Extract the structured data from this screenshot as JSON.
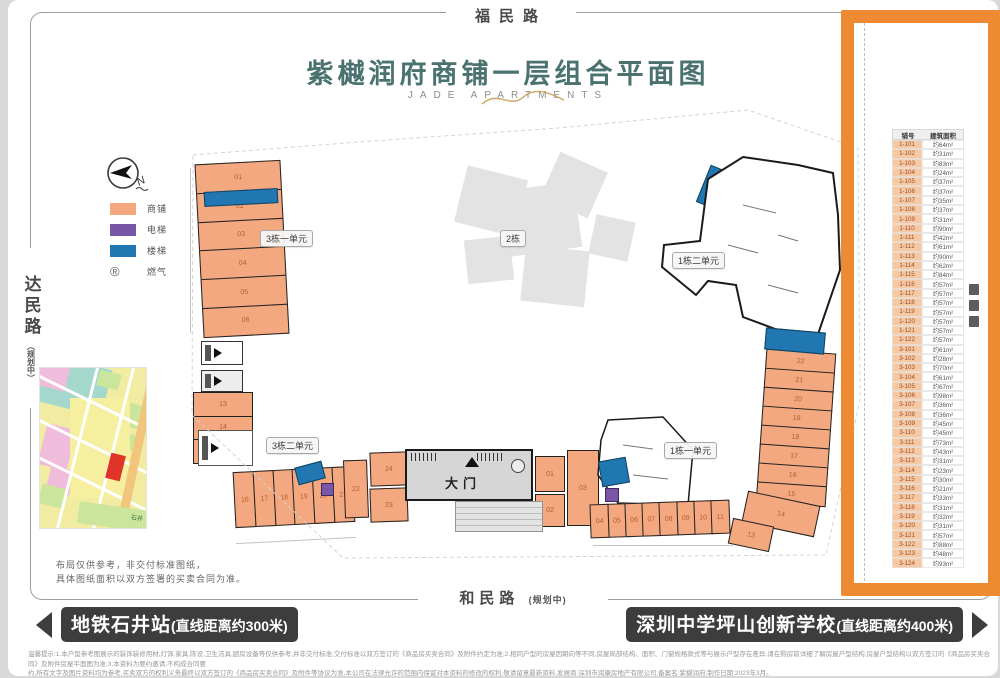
{
  "colors": {
    "shop": "#f3a87f",
    "elev": "#7a57a6",
    "stair": "#2077b2",
    "highlight": "#ee8a31",
    "title": "#4a7370",
    "bar": "#3d3d3d"
  },
  "header": {
    "title": "紫樾润府商铺一层组合平面图",
    "subtitle": "JADE APARTMENTS"
  },
  "roads": {
    "top": "福民路",
    "left": "达民路",
    "left_sub": "（规划中）",
    "bottom": "和民路",
    "bottom_sub": "(规划中)"
  },
  "legend": {
    "north": "N",
    "items": [
      {
        "label": "商铺"
      },
      {
        "label": "电梯"
      },
      {
        "label": "楼梯"
      },
      {
        "label": "燃气",
        "symbol": "®"
      }
    ]
  },
  "plan": {
    "badges": {
      "b3u1": "3栋一单元",
      "b2": "2栋",
      "b1u2": "1栋二单元",
      "b3u2": "3栋二单元",
      "b1u1": "1栋一单元"
    },
    "gate_label": "大门",
    "shops": {
      "b3u1": [
        "01",
        "02",
        "03",
        "04",
        "05",
        "06"
      ],
      "b3u2_col": [
        "13",
        "14",
        "15"
      ],
      "b3u2_row": [
        "16",
        "17",
        "18",
        "19",
        "20",
        "21"
      ],
      "gate_left_22": "22",
      "gate_left_24": "24",
      "gate_left_23": "23",
      "gate_right_01": "01",
      "gate_right_03": "03",
      "gate_right_02": "02",
      "b1u1_row": [
        "04",
        "05",
        "06",
        "07",
        "08",
        "09",
        "10",
        "11"
      ],
      "east": [
        "22",
        "21",
        "20",
        "19",
        "18",
        "17",
        "16",
        "15"
      ],
      "east_14": "14",
      "east_13": "13"
    }
  },
  "inset_map": {
    "label": "石井"
  },
  "note": [
    "布局仅供参考，非交付标准图纸，",
    "具体图纸面积以双方签署的买卖合同为准。"
  ],
  "poi": {
    "left": {
      "name": "地铁石井站",
      "distance": "(直线距离约300米)"
    },
    "right": {
      "name": "深圳中学坪山创新学校",
      "distance": "(直线距离约400米)"
    }
  },
  "disclaimer": [
    "温馨提示:1.本户型参考图展示的装饰装修用材,灯饰,家具,陈设,卫生洁具,厨房设备等仅供参考,并非交付标准;交付标准以双方签订的《商品房买卖合同》及附件约定为准;2.相同户型的房屋因朝向等不同,房屋局部结构、面积、门窗规格款式等与展示户型存在差异,请在购房前详细了解房屋户型结构,房屋户型结构以双方签订的《商品房买卖合同》及附件房屋平面图为准;3.本资料为要约邀请,不构成合同要",
    "约,所有文字及图片资料均为参考,买卖双方的权利义务最终以双方签订的《商品房买卖合同》及附件等协议为准,本公司在法律允许的范围内保留对本资料的修改的权利,敬请留意最新资料,发展商:深圳市润康房地产有限公司;备案名:紫樾润府;制作日期:2023年3月。"
  ],
  "table": {
    "headers": [
      "铺号",
      "建筑面积"
    ],
    "rows": [
      [
        "1-101",
        "约64m²"
      ],
      [
        "1-102",
        "约31m²"
      ],
      [
        "1-103",
        "约83m²"
      ],
      [
        "1-104",
        "约24m²"
      ],
      [
        "1-105",
        "约37m²"
      ],
      [
        "1-106",
        "约37m²"
      ],
      [
        "1-107",
        "约35m²"
      ],
      [
        "1-108",
        "约37m²"
      ],
      [
        "1-109",
        "约31m²"
      ],
      [
        "1-110",
        "约90m²"
      ],
      [
        "1-111",
        "约42m²"
      ],
      [
        "1-112",
        "约61m²"
      ],
      [
        "1-113",
        "约90m²"
      ],
      [
        "1-114",
        "约62m²"
      ],
      [
        "1-115",
        "约84m²"
      ],
      [
        "1-116",
        "约57m²"
      ],
      [
        "1-117",
        "约57m²"
      ],
      [
        "1-118",
        "约57m²"
      ],
      [
        "1-119",
        "约57m²"
      ],
      [
        "1-120",
        "约57m²"
      ],
      [
        "1-121",
        "约57m²"
      ],
      [
        "1-122",
        "约57m²"
      ],
      [
        "3-101",
        "约61m²"
      ],
      [
        "3-102",
        "约28m²"
      ],
      [
        "3-103",
        "约70m²"
      ],
      [
        "3-104",
        "约61m²"
      ],
      [
        "3-105",
        "约67m²"
      ],
      [
        "3-106",
        "约98m²"
      ],
      [
        "3-107",
        "约36m²"
      ],
      [
        "3-108",
        "约36m²"
      ],
      [
        "3-109",
        "约45m²"
      ],
      [
        "3-110",
        "约45m²"
      ],
      [
        "3-111",
        "约73m²"
      ],
      [
        "3-112",
        "约43m²"
      ],
      [
        "3-113",
        "约31m²"
      ],
      [
        "3-114",
        "约23m²"
      ],
      [
        "3-115",
        "约30m²"
      ],
      [
        "3-116",
        "约21m²"
      ],
      [
        "3-117",
        "约33m²"
      ],
      [
        "3-118",
        "约31m²"
      ],
      [
        "3-119",
        "约32m²"
      ],
      [
        "3-120",
        "约31m²"
      ],
      [
        "3-121",
        "约57m²"
      ],
      [
        "3-122",
        "约88m²"
      ],
      [
        "3-123",
        "约48m²"
      ],
      [
        "3-124",
        "约93m²"
      ]
    ]
  }
}
